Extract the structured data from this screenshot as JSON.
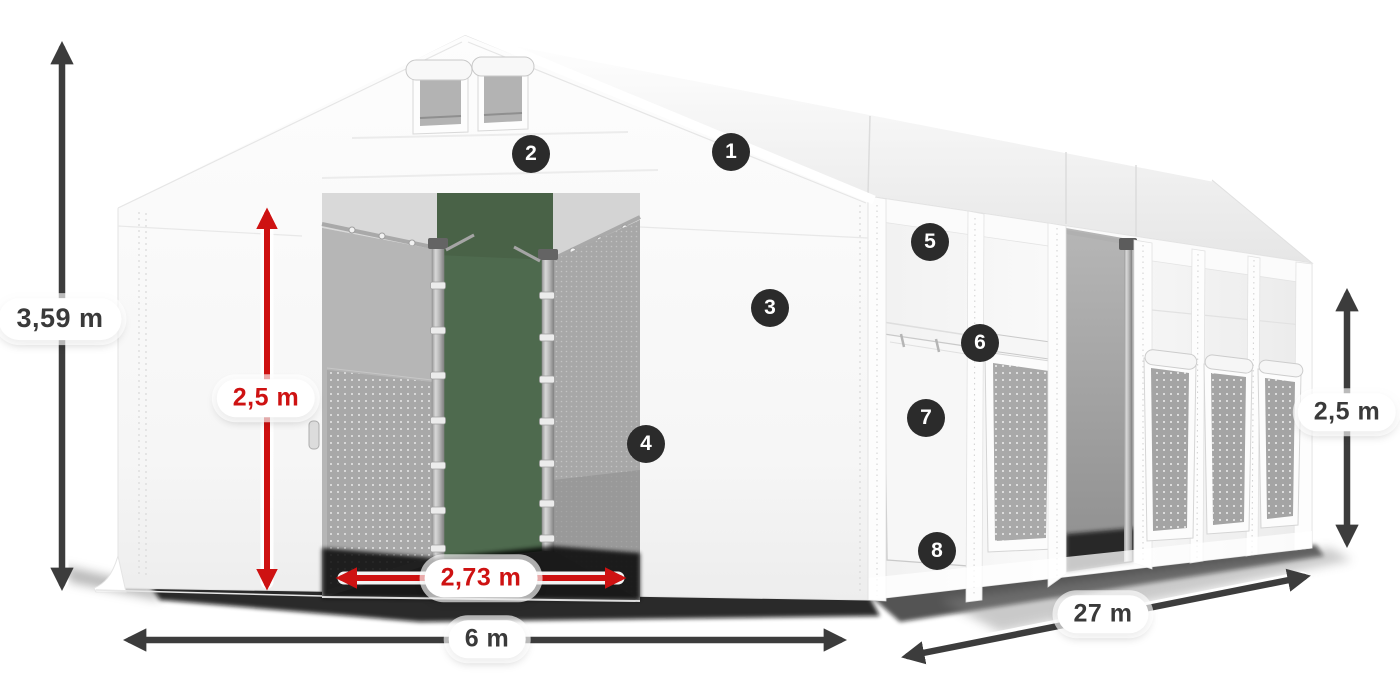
{
  "canvas": {
    "width": 1400,
    "height": 700,
    "background": "#ffffff"
  },
  "dimensions": {
    "total_height": {
      "label": "3,59 m",
      "color": "#3a3a3a",
      "orientation": "vertical"
    },
    "entrance_height": {
      "label": "2,5 m",
      "color": "#ce1212",
      "orientation": "vertical"
    },
    "entrance_width": {
      "label": "2,73 m",
      "color": "#ce1212",
      "orientation": "horizontal"
    },
    "front_width": {
      "label": "6 m",
      "color": "#3a3a3a",
      "orientation": "horizontal"
    },
    "side_length": {
      "label": "27 m",
      "color": "#3a3a3a",
      "orientation": "diagonal"
    },
    "side_wall_height": {
      "label": "2,5 m",
      "color": "#3a3a3a",
      "orientation": "vertical"
    }
  },
  "feature_markers": [
    {
      "number": "1"
    },
    {
      "number": "2"
    },
    {
      "number": "3"
    },
    {
      "number": "4"
    },
    {
      "number": "5"
    },
    {
      "number": "6"
    },
    {
      "number": "7"
    },
    {
      "number": "8"
    }
  ],
  "colors": {
    "dimension_red": "#ce1212",
    "dimension_dark": "#3c3c3c",
    "marker_background": "#2b2b2b",
    "marker_text": "#ffffff",
    "tent_white": "#f7f7f7",
    "interior_green": "#4e6a4e"
  }
}
